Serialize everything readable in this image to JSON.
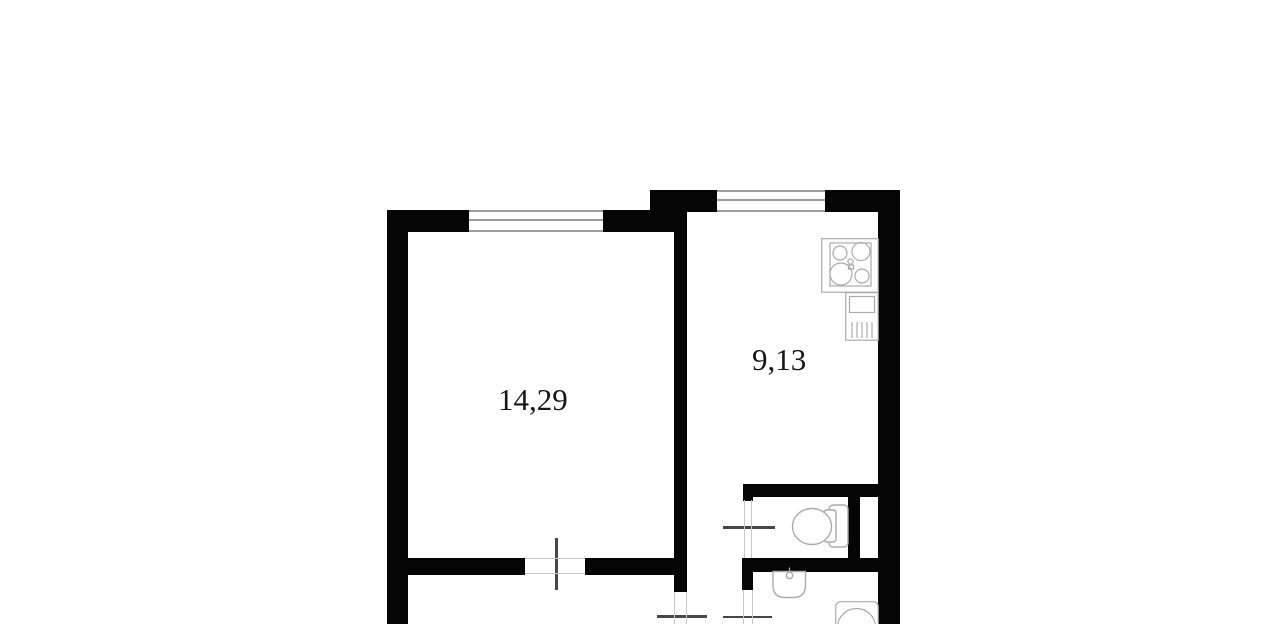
{
  "plan": {
    "type": "apartment-floor-plan",
    "rooms": [
      {
        "id": "living-room",
        "area_label": "14,29"
      },
      {
        "id": "kitchen",
        "area_label": "9,13"
      }
    ],
    "fixtures": [
      {
        "icon": "stove-icon",
        "room": "kitchen"
      },
      {
        "icon": "kitchen-sink-icon",
        "room": "kitchen"
      },
      {
        "icon": "toilet-icon",
        "room": "wc"
      },
      {
        "icon": "washbasin-icon",
        "room": "bathroom"
      },
      {
        "icon": "washing-machine-icon",
        "room": "bathroom"
      }
    ],
    "colors": {
      "wall": "#050505",
      "background": "#ffffff",
      "fixture_outline": "#ababab",
      "door_line": "#474747",
      "thin_line": "#c9c9c9",
      "window_line": "#9c9c9c",
      "label": "#161616"
    }
  }
}
